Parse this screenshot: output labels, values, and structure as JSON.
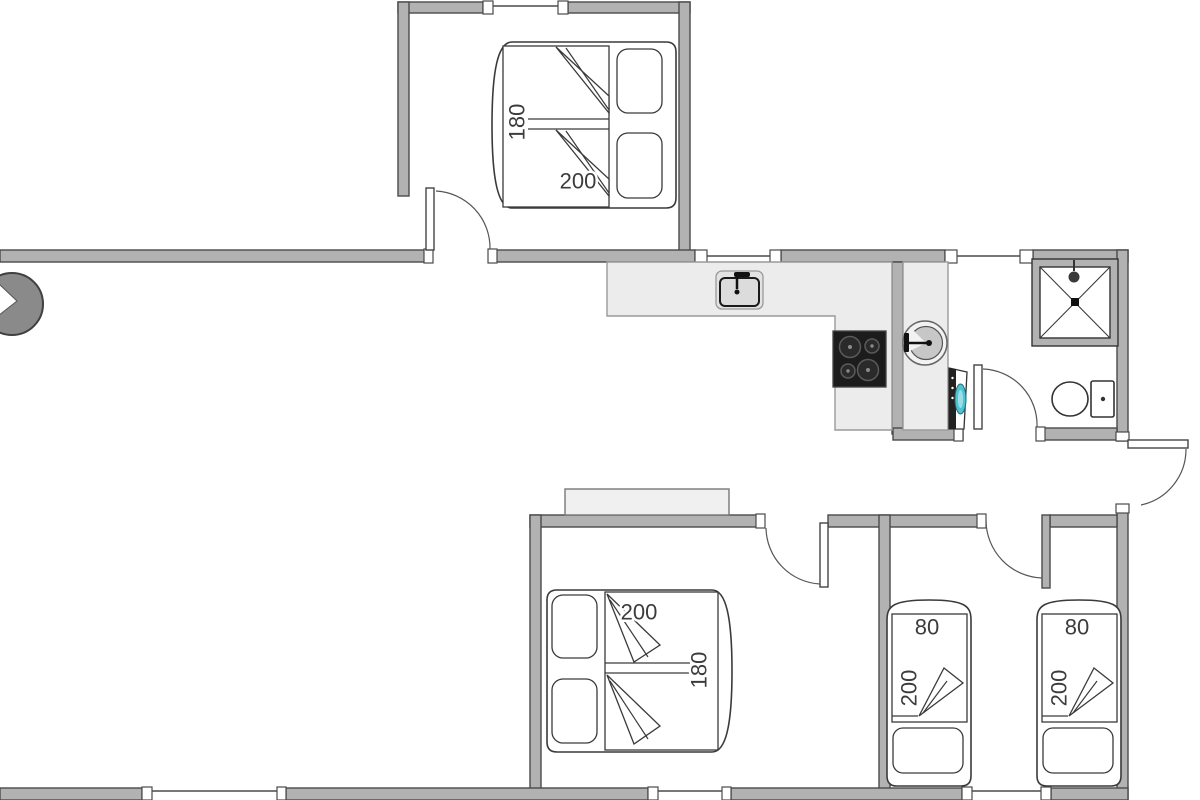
{
  "floor_plan": {
    "bedroom_top_double_bed": {
      "width": "180",
      "length": "200"
    },
    "bedroom_middle_double_bed": {
      "length": "200",
      "width": "180"
    },
    "bedroom_right_single_bed_1": {
      "width": "80",
      "length": "200"
    },
    "bedroom_right_single_bed_2": {
      "width": "80",
      "length": "200"
    }
  }
}
